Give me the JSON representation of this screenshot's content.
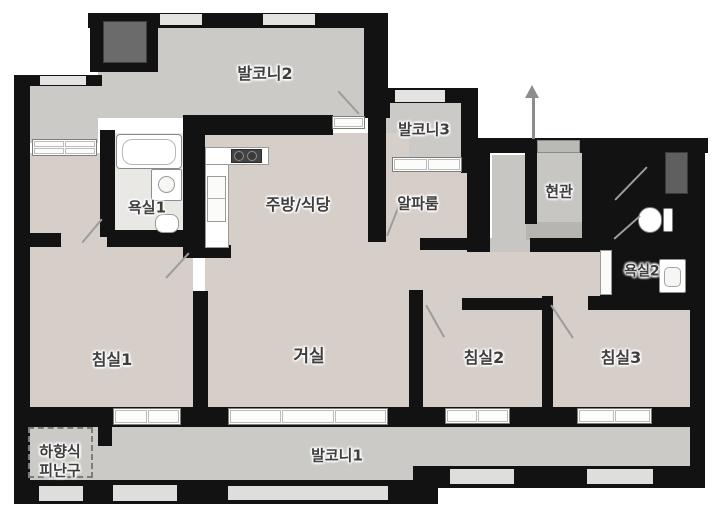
{
  "canvas": {
    "w": 719,
    "h": 512,
    "bg": "#ffffff"
  },
  "colors": {
    "wall": "#121212",
    "balcony_floor": "#cbcac6",
    "room_floor": "#d6cec8",
    "bath_floor": "#e9e8e5",
    "entry_floor": "#c7c6c3",
    "entry_mat": "#b6b5b2",
    "window_light": "#e3e3e1",
    "window_white": "#ffffff",
    "duct": "#5f5f5f",
    "ac_unit": "#6b6b6b",
    "door_line": "#9c9c9a",
    "label_text": "#3e3e3e"
  },
  "plan": {
    "floors": [
      {
        "n": "balcony2-floor",
        "r": [
          148,
          26,
          216,
          92
        ],
        "c": "#cbcac6"
      },
      {
        "n": "balcony2-floor-ext",
        "r": [
          98,
          67,
          52,
          51
        ],
        "c": "#cbcac6"
      },
      {
        "n": "left-wing-floor",
        "r": [
          27,
          85,
          71,
          58
        ],
        "c": "#cbcac6"
      },
      {
        "n": "balcony3-floor",
        "r": [
          386,
          103,
          77,
          56
        ],
        "c": "#cbcac6"
      },
      {
        "n": "bedroom1-floor",
        "r": [
          30,
          153,
          163,
          256
        ],
        "c": "#d6cec8"
      },
      {
        "n": "kitchen-living-floor",
        "r": [
          205,
          133,
          204,
          276
        ],
        "c": "#d6cec8"
      },
      {
        "n": "alpha-room-floor",
        "r": [
          383,
          170,
          84,
          68
        ],
        "c": "#d6cec8"
      },
      {
        "n": "alpha-door-gap-floor",
        "r": [
          386,
          238,
          34,
          13
        ],
        "c": "#d6cec8"
      },
      {
        "n": "corridor-floor",
        "r": [
          409,
          250,
          192,
          48
        ],
        "c": "#d6cec8"
      },
      {
        "n": "bedroom2-door-gap-floor",
        "r": [
          423,
          298,
          39,
          13
        ],
        "c": "#d6cec8"
      },
      {
        "n": "bedroom3-door-gap-floor",
        "r": [
          553,
          298,
          35,
          13
        ],
        "c": "#d6cec8"
      },
      {
        "n": "bedroom2-floor",
        "r": [
          422,
          310,
          120,
          99
        ],
        "c": "#d6cec8"
      },
      {
        "n": "bedroom3-floor",
        "r": [
          553,
          310,
          137,
          99
        ],
        "c": "#d6cec8"
      },
      {
        "n": "bathroom1-floor",
        "r": [
          113,
          133,
          70,
          100
        ],
        "c": "#e9e8e5",
        "speckle": true
      },
      {
        "n": "entry-passage-floor",
        "r": [
          492,
          155,
          38,
          95
        ],
        "c": "#c7c6c3",
        "dots": true
      },
      {
        "n": "entry-hall-floor",
        "r": [
          537,
          153,
          45,
          70
        ],
        "c": "#c7c6c3",
        "dots": true
      },
      {
        "n": "entry-threshold-floor",
        "r": [
          490,
          238,
          40,
          14
        ],
        "c": "#c7c6c3",
        "dots": true
      },
      {
        "n": "entry-mat",
        "r": [
          526,
          222,
          56,
          18
        ],
        "c": "#b6b5b2",
        "dots": true
      },
      {
        "n": "shower-room-floor",
        "r": [
          612,
          155,
          47,
          48
        ],
        "c": "#c9c8c5"
      },
      {
        "n": "toilet-room-floor",
        "r": [
          612,
          205,
          64,
          33
        ],
        "c": "#c9c8c5"
      },
      {
        "n": "bathroom2-floor",
        "r": [
          612,
          240,
          76,
          56
        ],
        "c": "#eceBe8",
        "speckle": true
      },
      {
        "n": "balcony1-floor-left",
        "r": [
          30,
          424,
          383,
          58
        ],
        "c": "#cbcac6"
      },
      {
        "n": "balcony1-floor-right",
        "r": [
          413,
          424,
          280,
          43
        ],
        "c": "#cbcac6"
      }
    ],
    "walls": [
      {
        "n": "wall-top-balcony2",
        "r": [
          88,
          13,
          300,
          15
        ]
      },
      {
        "n": "wall-ac-block",
        "r": [
          90,
          13,
          68,
          59
        ]
      },
      {
        "n": "wall-balcony2-right",
        "r": [
          364,
          13,
          24,
          105
        ]
      },
      {
        "n": "wall-balcony3-left",
        "r": [
          368,
          88,
          22,
          30
        ]
      },
      {
        "n": "wall-alpha-left",
        "r": [
          368,
          110,
          18,
          132
        ]
      },
      {
        "n": "wall-kitchen-top",
        "r": [
          183,
          115,
          150,
          20
        ]
      },
      {
        "n": "wall-left-wing-top",
        "r": [
          14,
          75,
          88,
          11
        ]
      },
      {
        "n": "wall-outer-left",
        "r": [
          14,
          75,
          16,
          429
        ]
      },
      {
        "n": "wall-bath1-left",
        "r": [
          100,
          130,
          15,
          107
        ]
      },
      {
        "n": "wall-bath1-right",
        "r": [
          183,
          130,
          22,
          127
        ]
      },
      {
        "n": "wall-bath1-bottom",
        "r": [
          107,
          230,
          80,
          17
        ]
      },
      {
        "n": "wall-left-stub",
        "r": [
          30,
          233,
          31,
          14
        ]
      },
      {
        "n": "wall-kitchen-stub",
        "r": [
          183,
          245,
          48,
          13
        ]
      },
      {
        "n": "wall-balcony3-top",
        "r": [
          377,
          88,
          101,
          15
        ]
      },
      {
        "n": "wall-balcony3-right",
        "r": [
          461,
          103,
          17,
          70
        ]
      },
      {
        "n": "wall-passage-left",
        "r": [
          467,
          140,
          23,
          112
        ]
      },
      {
        "n": "wall-top-right-wing",
        "r": [
          478,
          138,
          230,
          15
        ]
      },
      {
        "n": "wall-passage-entry-divider",
        "r": [
          525,
          153,
          12,
          71
        ]
      },
      {
        "n": "wall-entry-right",
        "r": [
          582,
          153,
          18,
          86
        ]
      },
      {
        "n": "wall-below-entry",
        "r": [
          530,
          238,
          82,
          14
        ]
      },
      {
        "n": "wall-below-alpha",
        "r": [
          420,
          238,
          53,
          12
        ]
      },
      {
        "n": "wall-right-wing-block",
        "r": [
          600,
          150,
          90,
          148
        ]
      },
      {
        "n": "wall-outer-right",
        "r": [
          690,
          138,
          15,
          342
        ]
      },
      {
        "n": "wall-bedroom3-top",
        "r": [
          588,
          296,
          117,
          14
        ]
      },
      {
        "n": "wall-bedroom2-top",
        "r": [
          462,
          298,
          80,
          12
        ]
      },
      {
        "n": "wall-bedroom-divider",
        "r": [
          542,
          296,
          11,
          114
        ]
      },
      {
        "n": "wall-living-bedroom2-divider",
        "r": [
          409,
          290,
          14,
          120
        ]
      },
      {
        "n": "wall-living-bedroom1-divider",
        "r": [
          193,
          291,
          15,
          120
        ]
      },
      {
        "n": "wall-window-band",
        "r": [
          30,
          407,
          660,
          20
        ]
      },
      {
        "n": "wall-outer-bottom-left",
        "r": [
          14,
          480,
          424,
          24
        ]
      },
      {
        "n": "wall-outer-bottom-right",
        "r": [
          413,
          466,
          292,
          22
        ]
      },
      {
        "n": "wall-hatch-stub",
        "r": [
          98,
          424,
          14,
          22
        ]
      }
    ],
    "lights": [
      {
        "n": "window-top-1",
        "r": [
          160,
          14,
          42,
          11
        ],
        "c": "#e3e3e1"
      },
      {
        "n": "window-top-2",
        "r": [
          263,
          14,
          52,
          11
        ],
        "c": "#e3e3e1"
      },
      {
        "n": "window-left-wing",
        "r": [
          40,
          76,
          46,
          9
        ],
        "c": "#e3e3e1"
      },
      {
        "n": "window-balcony3-top",
        "r": [
          395,
          90,
          50,
          12
        ],
        "c": "#e3e3e1"
      },
      {
        "n": "window-bottom-1",
        "r": [
          39,
          486,
          44,
          15
        ],
        "c": "#dededc"
      },
      {
        "n": "window-bottom-2",
        "r": [
          113,
          485,
          64,
          16
        ],
        "c": "#dededc"
      },
      {
        "n": "window-bottom-3",
        "r": [
          228,
          486,
          160,
          14
        ],
        "c": "#dededc"
      },
      {
        "n": "window-bottom-4",
        "r": [
          450,
          469,
          64,
          15
        ],
        "c": "#dededc"
      },
      {
        "n": "window-bottom-5",
        "r": [
          587,
          469,
          66,
          15
        ],
        "c": "#dededc"
      }
    ],
    "windows": [
      {
        "n": "window-bedroom1-upper",
        "r": [
          32,
          139,
          65,
          17
        ],
        "cols": 2,
        "rows": 2
      },
      {
        "n": "window-balcony2-kitchen-sill",
        "r": [
          332,
          116,
          33,
          13
        ],
        "cols": 1,
        "rows": 1
      },
      {
        "n": "window-alpha-balcony3",
        "r": [
          392,
          157,
          70,
          15
        ],
        "cols": 2,
        "rows": 1
      },
      {
        "n": "window-bedroom1-balcony",
        "r": [
          113,
          408,
          68,
          17
        ],
        "cols": 2,
        "rows": 1
      },
      {
        "n": "window-living-balcony",
        "r": [
          228,
          408,
          160,
          17
        ],
        "cols": 3,
        "rows": 1
      },
      {
        "n": "window-bedroom2-balcony",
        "r": [
          445,
          408,
          65,
          16
        ],
        "cols": 2,
        "rows": 1
      },
      {
        "n": "window-bedroom3-balcony",
        "r": [
          577,
          408,
          75,
          16
        ],
        "cols": 2,
        "rows": 1
      }
    ],
    "boxes": [
      {
        "n": "ac-unit",
        "r": [
          103,
          21,
          44,
          42
        ],
        "bg": "#6b6b6b",
        "bd": "#3f3f3f"
      },
      {
        "n": "duct-shaft",
        "r": [
          665,
          152,
          23,
          42
        ],
        "bg": "#5f5f5f",
        "bd": "#3a3a3a"
      },
      {
        "n": "bathtub",
        "r": [
          116,
          134,
          66,
          35
        ],
        "bg": "#ffffff",
        "bd": "#8a8a8a",
        "rad": 4
      },
      {
        "n": "bathtub-inner",
        "r": [
          122,
          139,
          54,
          26
        ],
        "bg": "transparent",
        "bd": "#b9b9b6",
        "rad": 10
      },
      {
        "n": "bathroom1-sink",
        "r": [
          151,
          169,
          31,
          32
        ],
        "bg": "#ffffff",
        "bd": "#8f8f8d",
        "rad": 2
      },
      {
        "n": "bathroom1-sink-bowl",
        "r": [
          158,
          176,
          17,
          17
        ],
        "bg": "#f6f6f4",
        "bd": "#9a9a98",
        "rad": 9
      },
      {
        "n": "bathroom1-toilet",
        "r": [
          155,
          214,
          24,
          19
        ],
        "bg": "#ffffff",
        "bd": "#9a9a98",
        "rad": 8
      },
      {
        "n": "kitchen-counter-vertical",
        "r": [
          205,
          147,
          24,
          101
        ],
        "bg": "#ffffff",
        "bd": "#9a9a98"
      },
      {
        "n": "kitchen-counter-horizontal",
        "r": [
          205,
          147,
          64,
          18
        ],
        "bg": "#ffffff",
        "bd": "#9a9a98"
      },
      {
        "n": "kitchen-stove",
        "r": [
          231,
          149,
          31,
          14
        ],
        "bg": "#434343",
        "bd": "#2c2c2c"
      },
      {
        "n": "stove-burner-1",
        "r": [
          234,
          151,
          10,
          10
        ],
        "bg": "#3a3a3a",
        "bd": "#8f8f8d",
        "rad": 6
      },
      {
        "n": "stove-burner-2",
        "r": [
          247,
          151,
          10,
          10
        ],
        "bg": "#3a3a3a",
        "bd": "#8f8f8d",
        "rad": 6
      },
      {
        "n": "kitchen-fridge",
        "r": [
          207,
          176,
          19,
          46
        ],
        "bg": "#fbfbfa",
        "bd": "#9a9a98"
      },
      {
        "n": "kitchen-fridge-divider",
        "r": [
          207,
          198,
          19,
          1
        ],
        "bg": "#b0b0ae"
      },
      {
        "n": "toilet2-tank",
        "r": [
          663,
          208,
          10,
          24
        ],
        "bg": "#ffffff",
        "bd": "#7e7e7c",
        "rad": 2
      },
      {
        "n": "toilet2-bowl",
        "r": [
          638,
          207,
          24,
          26
        ],
        "bg": "#ffffff",
        "bd": "#7e7e7c",
        "rad": 13
      },
      {
        "n": "bathroom2-sink",
        "r": [
          659,
          259,
          27,
          34
        ],
        "bg": "#ffffff",
        "bd": "#8f8f8d",
        "rad": 2
      },
      {
        "n": "bathroom2-sink-bowl",
        "r": [
          664,
          267,
          17,
          20
        ],
        "bg": "#f6f6f4",
        "bd": "#a5a5a3",
        "rad": 5
      },
      {
        "n": "bathroom2-door",
        "r": [
          600,
          250,
          12,
          45
        ],
        "bg": "#fafaf9",
        "bd": "#9a9a98"
      },
      {
        "n": "entry-door",
        "r": [
          537,
          140,
          43,
          13
        ],
        "bg": "#b9b9b6",
        "bd": "#8a8a88"
      },
      {
        "n": "escape-hatch-outline",
        "r": [
          28,
          427,
          65,
          51
        ],
        "bg": "transparent",
        "bd": "#7c7c7a",
        "dash": true
      }
    ],
    "doors": [
      {
        "n": "bathroom1-door-swing",
        "p": [
          102,
          218,
          82,
          242
        ]
      },
      {
        "n": "bedroom1-door-swing",
        "p": [
          189,
          252,
          166,
          277
        ]
      },
      {
        "n": "balcony2-door-swing",
        "p": [
          359,
          113,
          338,
          90
        ]
      },
      {
        "n": "alpha-room-door-swing",
        "p": [
          387,
          235,
          402,
          197
        ]
      },
      {
        "n": "bedroom2-door-swing",
        "p": [
          426,
          304,
          444,
          336
        ]
      },
      {
        "n": "bedroom3-door-swing",
        "p": [
          551,
          304,
          573,
          337
        ]
      },
      {
        "n": "shower-room-door-swing",
        "p": [
          615,
          199,
          647,
          166
        ]
      },
      {
        "n": "toilet-room-door-swing",
        "p": [
          614,
          238,
          640,
          215
        ]
      }
    ],
    "arrow": {
      "n": "entrance-direction-arrow",
      "x": 533,
      "y1": 97,
      "y2": 139
    },
    "labels": [
      {
        "n": "label-balcony2",
        "text": "발코니2",
        "x": 265,
        "y": 74,
        "s": 16
      },
      {
        "n": "label-balcony3",
        "text": "발코니3",
        "x": 424,
        "y": 130,
        "s": 15
      },
      {
        "n": "label-bathroom1",
        "text": "욕실1",
        "x": 147,
        "y": 208,
        "s": 15
      },
      {
        "n": "label-kitchen-dining",
        "text": "주방/식당",
        "x": 298,
        "y": 205,
        "s": 16
      },
      {
        "n": "label-alpha-room",
        "text": "알파룸",
        "x": 418,
        "y": 204,
        "s": 15
      },
      {
        "n": "label-entrance",
        "text": "현관",
        "x": 559,
        "y": 192,
        "s": 15
      },
      {
        "n": "label-bathroom2",
        "text": "욕실2",
        "x": 642,
        "y": 272,
        "s": 14
      },
      {
        "n": "label-bedroom1",
        "text": "침실1",
        "x": 112,
        "y": 360,
        "s": 16
      },
      {
        "n": "label-living-room",
        "text": "거실",
        "x": 309,
        "y": 357,
        "s": 17
      },
      {
        "n": "label-bedroom2",
        "text": "침실2",
        "x": 484,
        "y": 358,
        "s": 16
      },
      {
        "n": "label-bedroom3",
        "text": "침실3",
        "x": 621,
        "y": 358,
        "s": 16
      },
      {
        "n": "label-balcony1",
        "text": "발코니1",
        "x": 337,
        "y": 456,
        "s": 15
      },
      {
        "n": "label-escape-hatch",
        "text": "하향식\n피난구",
        "x": 60,
        "y": 461,
        "s": 15
      }
    ]
  }
}
